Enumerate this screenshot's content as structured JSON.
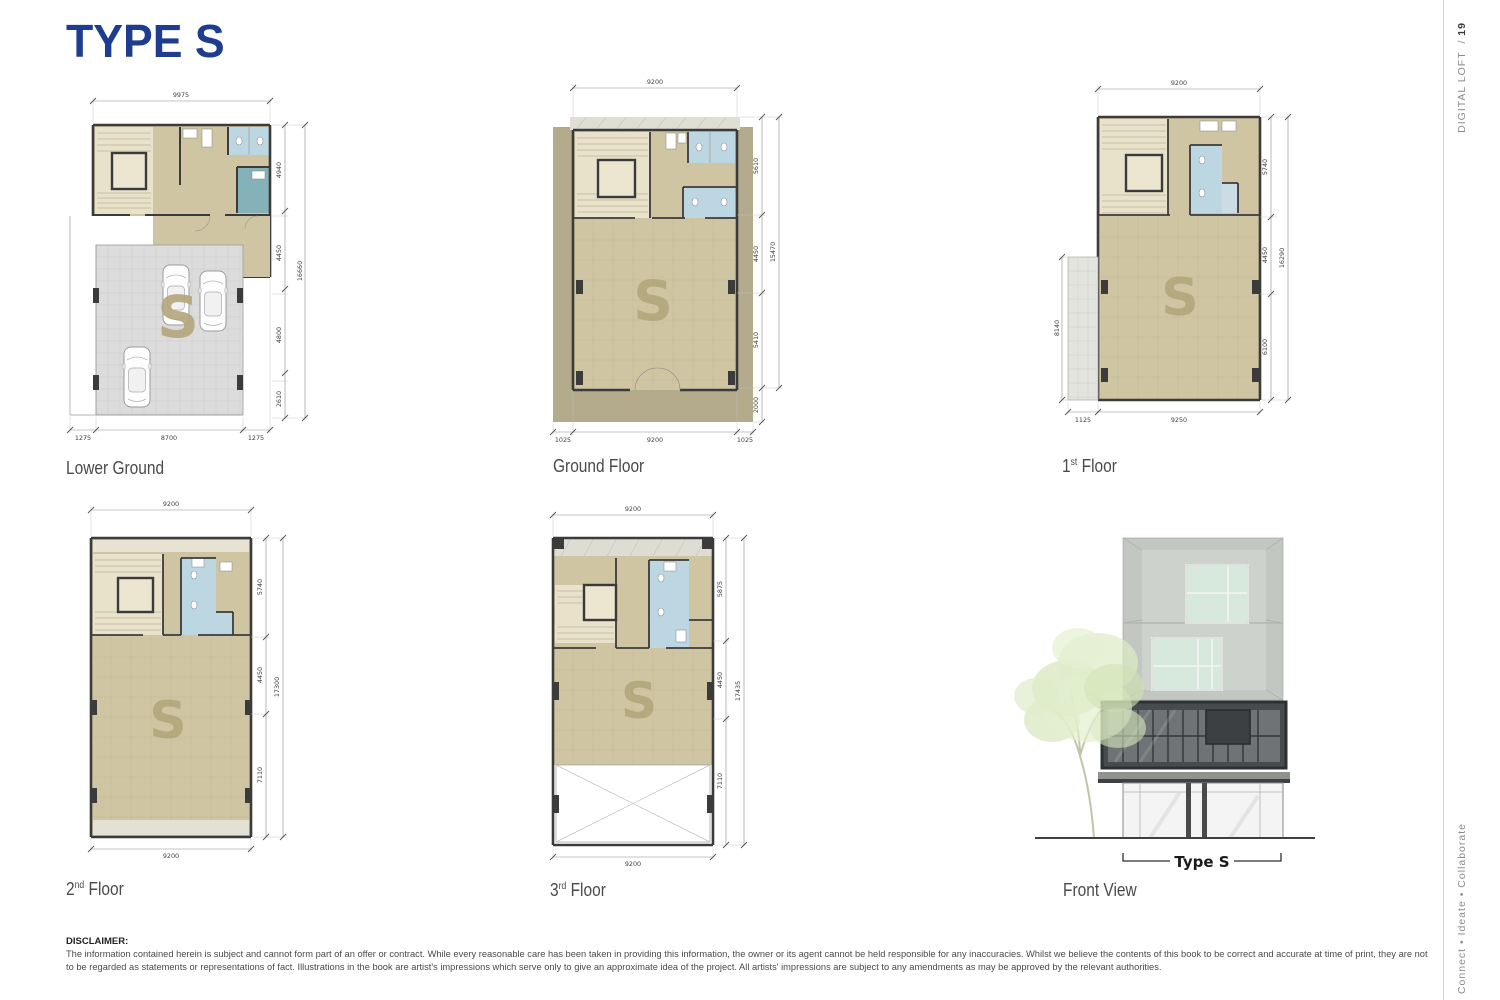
{
  "page": {
    "title": "TYPE S",
    "sidebar": {
      "publication": "DIGITAL LOFT",
      "separator": "/",
      "page_no": "19",
      "tagline": "Connect • Ideate • Collaborate"
    },
    "disclaimer": {
      "heading": "DISCLAIMER:",
      "body": "The information contained herein is subject and cannot form part of an offer or contract. While every reasonable care has been taken in providing this information, the owner or its agent cannot be held responsible for any inaccuracies. Whilst we believe the contents of this book to be correct and accurate at time of print, they are not to be regarded as statements or representations of fact. Illustrations in the book are artist's impressions which serve only to give an approximate idea of the project. All artists' impressions are subject to any amendments as may be approved by the relevant authorities."
    }
  },
  "colors": {
    "title_blue": "#1e3d8f",
    "floor_tan": "#cfc5a2",
    "surround_tan": "#b3ab8b",
    "stair_cream": "#e9e2cb",
    "bath_blue": "#bdd7e2",
    "teal_room": "#85b2b9",
    "wall_dark": "#3b3b3b",
    "garage_grey": "#dcdcdc",
    "watermark_tan": "#b2a67c"
  },
  "plans": {
    "lower_ground": {
      "name": "Lower Ground",
      "watermark": "S",
      "dim_top": "9975",
      "dims_right": [
        "4940",
        "4450",
        "4800",
        "2610"
      ],
      "dim_right_total": "16660",
      "dims_bottom": [
        "1275",
        "8700",
        "1275"
      ]
    },
    "ground": {
      "name": "Ground Floor",
      "watermark": "S",
      "dim_top": "9200",
      "dims_right": [
        "5610",
        "4450",
        "5410",
        "2000"
      ],
      "dim_right_total": "15470",
      "dims_bottom": [
        "1025",
        "9200",
        "1025"
      ]
    },
    "first": {
      "num": "1",
      "ord": "st",
      "word": "Floor",
      "watermark": "S",
      "dim_top": "9200",
      "dims_right": [
        "5740",
        "4450",
        "6100"
      ],
      "dim_right_total": "16290",
      "dim_left": "8140",
      "dims_bottom": [
        "1125",
        "9250"
      ]
    },
    "second": {
      "num": "2",
      "ord": "nd",
      "word": "Floor",
      "watermark": "S",
      "dim_top": "9200",
      "dims_right": [
        "5740",
        "4450",
        "7110"
      ],
      "dim_right_total": "17300",
      "dim_bottom": "9200"
    },
    "third": {
      "num": "3",
      "ord": "rd",
      "word": "Floor",
      "watermark": "S",
      "dim_top": "9200",
      "dims_right": [
        "5875",
        "4450",
        "7110"
      ],
      "dim_right_total": "17435",
      "dim_bottom": "9200"
    },
    "front": {
      "name": "Front View",
      "tag": "Type S"
    }
  }
}
